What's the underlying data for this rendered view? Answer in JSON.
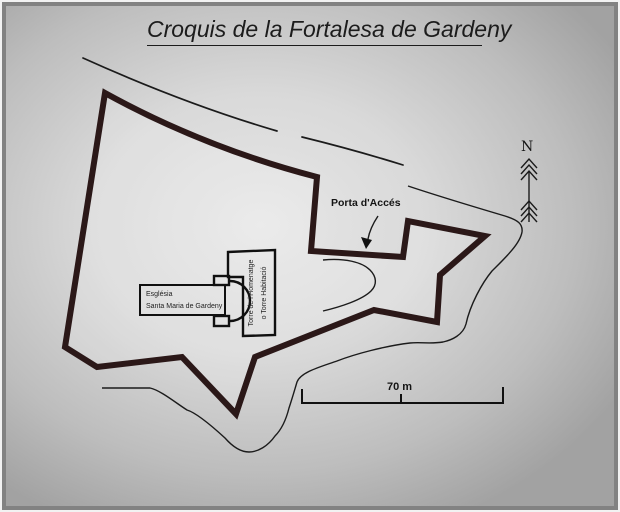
{
  "title": "Croquis de la Fortalesa de Gardeny",
  "map": {
    "gate_label": "Porta d'Accés",
    "church": {
      "line1": "Església",
      "line2": "Santa Maria de Gardeny"
    },
    "tower": {
      "line1": "Torre de l'Homenatge",
      "line2": "o Torre Habitació"
    },
    "north_label": "N",
    "scale_label": "70 m"
  },
  "colors": {
    "wall": "#2b1818",
    "line": "#1b1b1b",
    "text": "#141414",
    "background_light": "#e7e7e7",
    "background_dark": "#a2a2a2",
    "frame": "#828282"
  }
}
